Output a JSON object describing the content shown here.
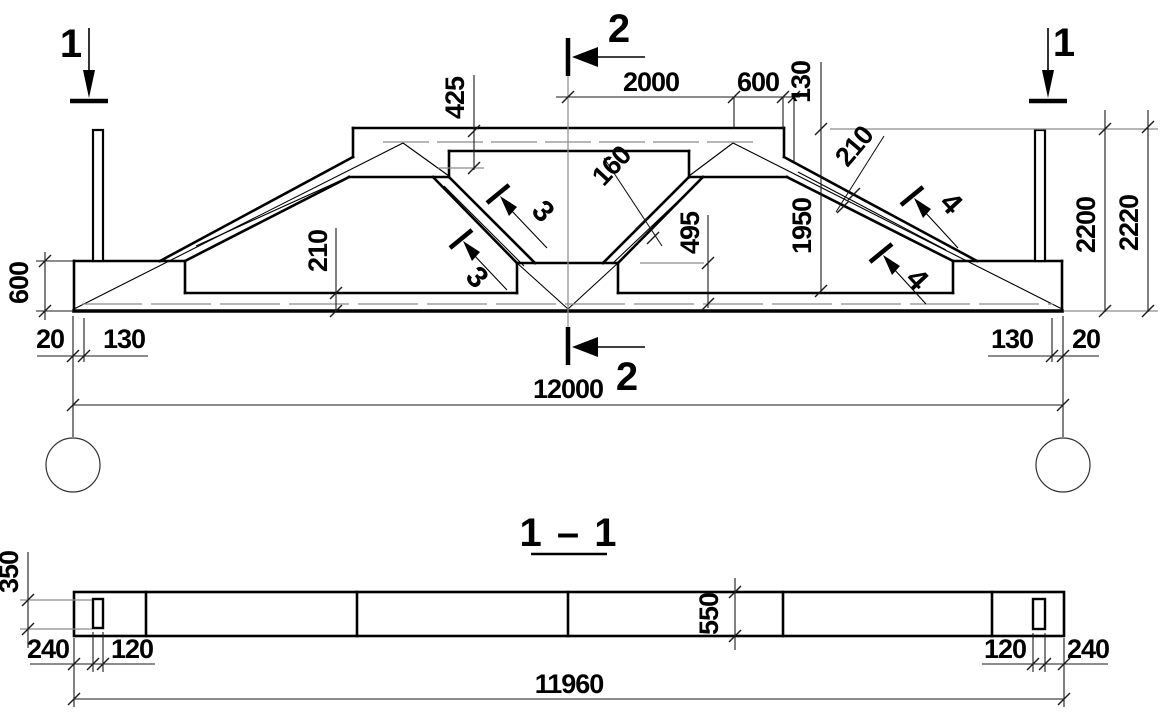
{
  "title": {
    "section_title": "1 – 1"
  },
  "markers": {
    "section1_left": "1",
    "section1_right": "1",
    "section2_top": "2",
    "section2_bottom": "2",
    "rebar3_upper": "3",
    "rebar3_lower": "3",
    "rebar4_upper": "4",
    "rebar4_lower": "4"
  },
  "dims": {
    "top_2000": "2000",
    "top_600": "600",
    "top_130": "130",
    "height_425": "425",
    "strut_160": "160",
    "height_495": "495",
    "height_1950": "1950",
    "height_2200": "2200",
    "height_2220": "2220",
    "left_600": "600",
    "chord_210": "210",
    "slope_210": "210",
    "bottom_left_20": "20",
    "bottom_left_130": "130",
    "bottom_right_130": "130",
    "bottom_right_20": "20",
    "span_12000": "12000"
  },
  "section": {
    "hole_350": "350",
    "left_240": "240",
    "left_120": "120",
    "depth_550": "550",
    "right_120": "120",
    "right_240": "240",
    "span_11960": "11960"
  }
}
